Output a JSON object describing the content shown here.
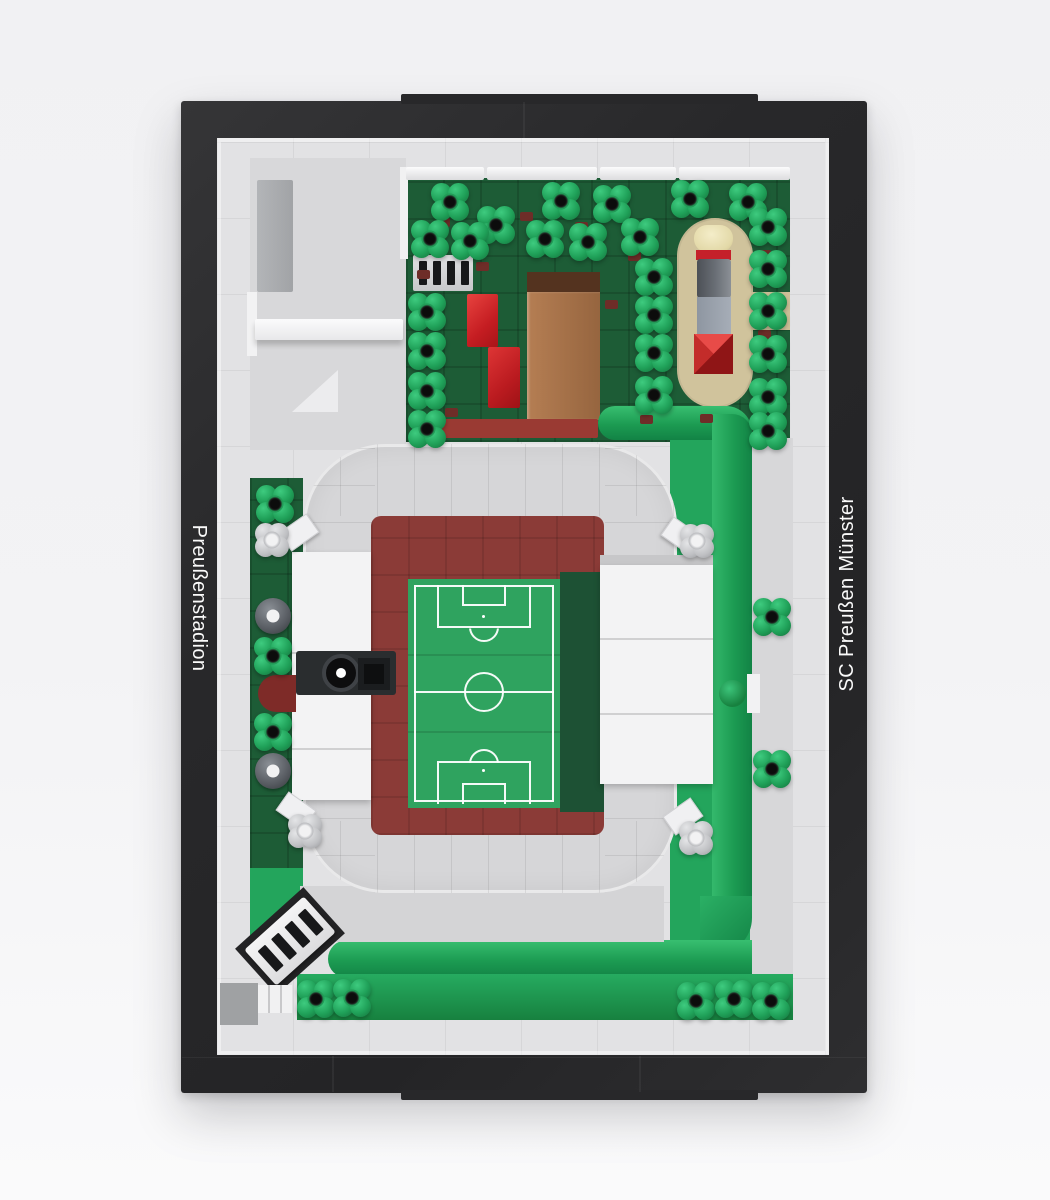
{
  "scene": {
    "description": "Top-down product photo of a brick-built model of a football stadium on a framed black baseplate",
    "left_label": "Preußenstadion",
    "right_label": "SC Preußen Münster"
  },
  "colors": {
    "frame_black": "#2a2a2c",
    "baseplate_gray": "#e2e2e4",
    "plate_gray": "#d6d6d8",
    "stand_white": "#f3f3f4",
    "track_maroon": "#8b3b37",
    "pitch_green": "#2fa35f",
    "pitch_shadow_green": "#1d5134",
    "garden_dark_green": "#1d5c36",
    "grass_bright_green": "#23a55c",
    "flower_green": "#1fa058",
    "tan_path": "#d0c39c",
    "brick_red": "#ce2127",
    "dark_red": "#9a3a33",
    "brown_dirt": "#a06c46",
    "label_text": "#fafafa"
  }
}
